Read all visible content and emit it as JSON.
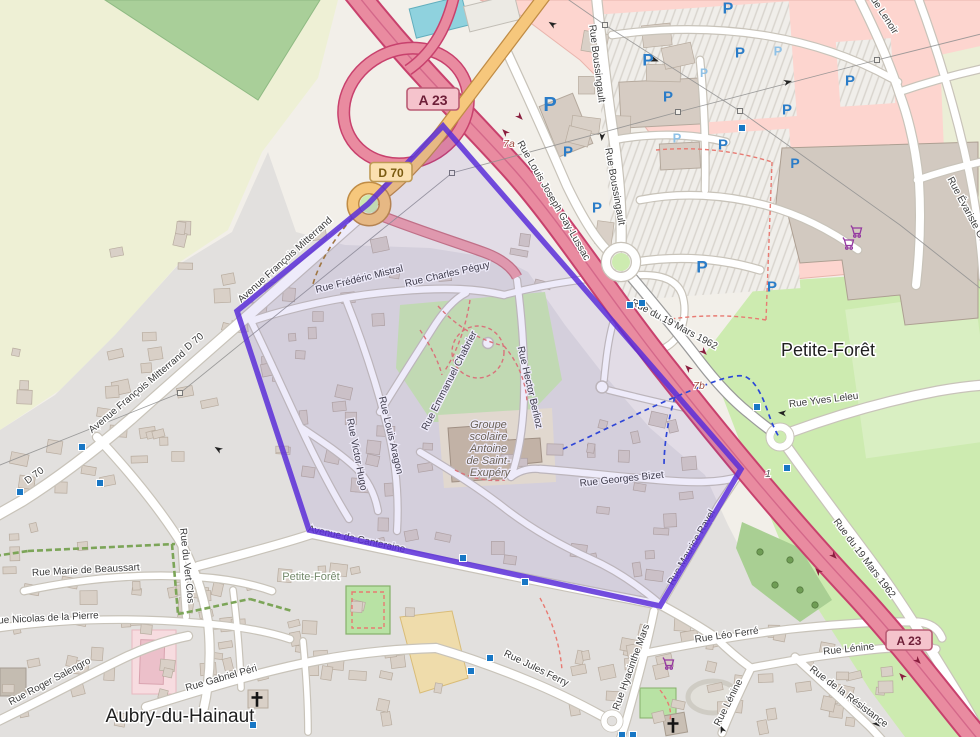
{
  "map": {
    "place_labels": [
      {
        "t": "Petite-Forêt",
        "x": 828,
        "y": 356,
        "s": 18
      },
      {
        "t": "Petite-Forêt",
        "x": 311,
        "y": 580,
        "s": 11
      },
      {
        "t": "Aubry-du-Hainaut",
        "x": 180,
        "y": 722,
        "s": 19
      }
    ],
    "school": {
      "lines": [
        "Groupe",
        "scolaire",
        "Antoine",
        "de Saint-",
        "Exupéry"
      ],
      "x": 490,
      "y": 428
    },
    "street_labels": [
      {
        "t": "Rue Boussingault",
        "x": 594,
        "y": 64,
        "r": 83
      },
      {
        "t": "Rue Boussingault",
        "x": 612,
        "y": 187,
        "r": 80
      },
      {
        "t": "Rue Louis Joseph Gay-Lussac",
        "x": 551,
        "y": 202,
        "r": 60
      },
      {
        "t": "Rue du 19 Mars 1962",
        "x": 673,
        "y": 327,
        "r": 28
      },
      {
        "t": "Rue du 19 Mars 1962",
        "x": 862,
        "y": 560,
        "r": 53
      },
      {
        "t": "Rue Yves Leleu",
        "x": 824,
        "y": 403,
        "r": -7
      },
      {
        "t": "Rue Lenoir",
        "x": 880,
        "y": 14,
        "r": 57
      },
      {
        "t": "Rue Évariste Galois",
        "x": 968,
        "y": 218,
        "r": 62
      },
      {
        "t": "Avenue François Mitterrand",
        "x": 287,
        "y": 262,
        "r": -42
      },
      {
        "t": "Avenue François Mitterrand",
        "x": 139,
        "y": 394,
        "r": -40
      },
      {
        "t": "D 70",
        "x": 196,
        "y": 344,
        "r": -40
      },
      {
        "t": "D 70",
        "x": 36,
        "y": 478,
        "r": -36
      },
      {
        "t": "Rue Frédéric Mistral",
        "x": 360,
        "y": 282,
        "r": -14
      },
      {
        "t": "Rue Charles Péguy",
        "x": 448,
        "y": 277,
        "r": -13
      },
      {
        "t": "Rue Emmanuel Chabrier",
        "x": 452,
        "y": 382,
        "r": -63
      },
      {
        "t": "Rue Hector Berlioz",
        "x": 527,
        "y": 388,
        "r": 77
      },
      {
        "t": "Rue Georges Bizet",
        "x": 622,
        "y": 482,
        "r": -6
      },
      {
        "t": "Rue Louis Aragon",
        "x": 388,
        "y": 436,
        "r": 77
      },
      {
        "t": "Rue Victor Hugo",
        "x": 354,
        "y": 455,
        "r": 79
      },
      {
        "t": "Rue Maurice Ravel",
        "x": 694,
        "y": 549,
        "r": -60
      },
      {
        "t": "Avenue de Canteraine",
        "x": 356,
        "y": 542,
        "r": 12
      },
      {
        "t": "Rue Marie de Beaussart",
        "x": 86,
        "y": 573,
        "r": -3
      },
      {
        "t": "Rue Nicolas de la Pierre",
        "x": 45,
        "y": 621,
        "r": -3
      },
      {
        "t": "Rue du Vert Clos",
        "x": 184,
        "y": 566,
        "r": 84
      },
      {
        "t": "Rue Roger Salengro",
        "x": 51,
        "y": 684,
        "r": -28
      },
      {
        "t": "Rue Gabriel Péri",
        "x": 222,
        "y": 681,
        "r": -16
      },
      {
        "t": "Rue Jules Ferry",
        "x": 535,
        "y": 671,
        "r": 26
      },
      {
        "t": "Rue Hyacinthe Mars",
        "x": 634,
        "y": 668,
        "r": -70
      },
      {
        "t": "Rue Léo Ferré",
        "x": 727,
        "y": 638,
        "r": -8
      },
      {
        "t": "Rue Lénine",
        "x": 849,
        "y": 652,
        "r": -6
      },
      {
        "t": "Rue Lénine",
        "x": 731,
        "y": 704,
        "r": -63
      },
      {
        "t": "Rue de la Résistance",
        "x": 847,
        "y": 699,
        "r": 37
      }
    ],
    "refs": [
      {
        "t": "7a",
        "x": 509,
        "y": 147,
        "c": "#9c4a3c"
      },
      {
        "t": "7b",
        "x": 699,
        "y": 389,
        "c": "#9c4a3c"
      },
      {
        "t": "1",
        "x": 768,
        "y": 477,
        "c": "#555555"
      }
    ],
    "badges": [
      {
        "t": "A 23",
        "x": 433,
        "y": 99,
        "w": 52,
        "h": 22,
        "f": 14,
        "type": "a"
      },
      {
        "t": "A 23",
        "x": 909,
        "y": 640,
        "w": 46,
        "h": 20,
        "f": 12,
        "type": "a"
      },
      {
        "t": "D 70",
        "x": 391,
        "y": 172,
        "w": 42,
        "h": 19,
        "f": 12,
        "type": "d"
      }
    ],
    "parking_icons": [
      [
        550,
        105,
        20,
        0
      ],
      [
        568,
        152,
        15,
        0
      ],
      [
        597,
        208,
        15,
        0
      ],
      [
        648,
        60,
        17,
        0
      ],
      [
        668,
        97,
        15,
        0
      ],
      [
        740,
        53,
        15,
        0
      ],
      [
        787,
        110,
        15,
        0
      ],
      [
        723,
        145,
        15,
        0
      ],
      [
        795,
        163,
        14,
        0
      ],
      [
        850,
        81,
        15,
        0
      ],
      [
        702,
        267,
        17,
        0
      ],
      [
        772,
        287,
        15,
        0
      ],
      [
        728,
        9,
        16,
        0
      ],
      [
        677,
        138,
        13,
        1
      ],
      [
        778,
        51,
        13,
        1
      ],
      [
        704,
        73,
        12,
        1
      ]
    ],
    "bus_stops": [
      [
        82,
        447
      ],
      [
        100,
        483
      ],
      [
        20,
        492
      ],
      [
        463,
        558
      ],
      [
        525,
        582
      ],
      [
        630,
        305
      ],
      [
        642,
        303
      ],
      [
        757,
        407
      ],
      [
        787,
        468
      ],
      [
        490,
        658
      ],
      [
        471,
        671
      ],
      [
        253,
        725
      ],
      [
        622,
        735
      ],
      [
        633,
        735
      ],
      [
        742,
        128
      ]
    ],
    "supermarket_icons": [
      [
        849,
        244
      ],
      [
        857,
        232
      ],
      [
        669,
        664
      ]
    ],
    "church_icons": [
      [
        257,
        700
      ],
      [
        673,
        726
      ]
    ],
    "route": {
      "points": "443,126 368,204 237,311 309,530 660,606 741,469",
      "stroke": "#5a2ed8",
      "fill": "rgba(88,55,205,0.10)"
    },
    "colors": {
      "base": "#f2efe9",
      "farmland": "#eef0d5",
      "forest": "#a9cf99",
      "residential": "#e2e0de",
      "retail": "#fdd5cf",
      "grass": "#cdebb0",
      "motorway": "#e98ba0",
      "motorway_casing": "#c8416d",
      "primary": "#f6c77c",
      "parking_blue": "#2a7cc8",
      "cart_purple": "#9438a0",
      "route_purple": "#5a2ed8",
      "cycleway_blue": "#2b48d8",
      "footpath_red": "#e87a72"
    }
  }
}
